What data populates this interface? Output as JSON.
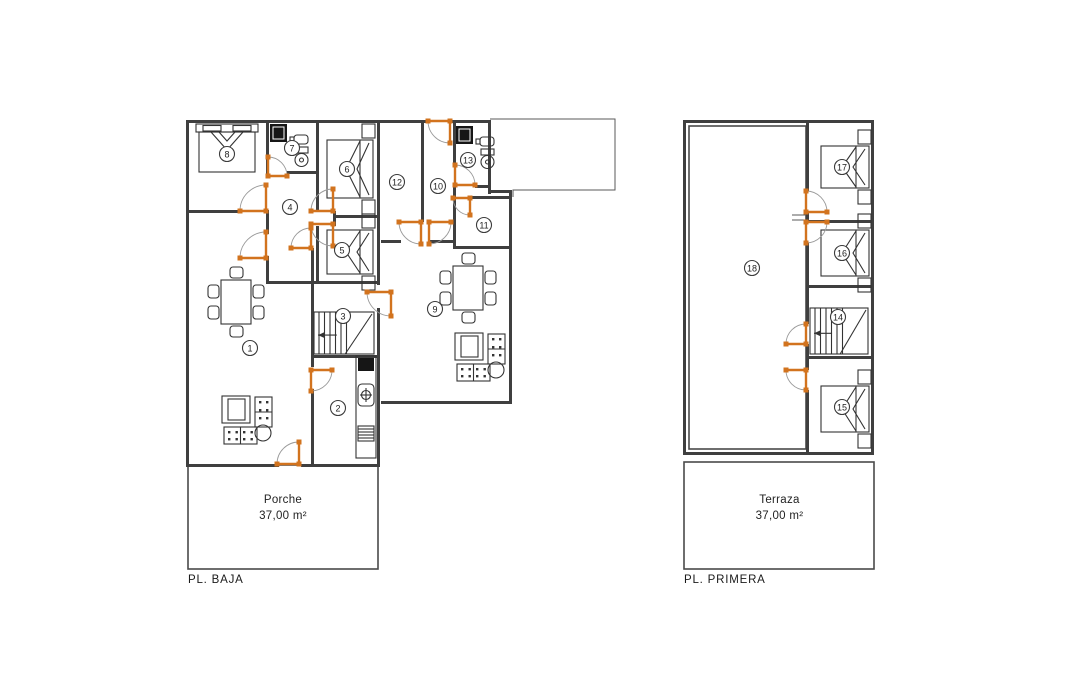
{
  "colors": {
    "wall": "#3f3f3f",
    "door_accent": "#d2731e",
    "swing_arc": "#9a9a9a",
    "text": "#222222"
  },
  "plans": [
    {
      "id": "baja",
      "label": "PL. BAJA",
      "label_pos": [
        188,
        574
      ],
      "area": {
        "title": "Porche",
        "value": "37,00 m²",
        "pos": [
          195,
          492,
          176
        ]
      },
      "walls": [
        {
          "x": 186,
          "y": 120,
          "w": 243,
          "h": 3
        },
        {
          "x": 450,
          "y": 120,
          "w": 41,
          "h": 3
        },
        {
          "x": 186,
          "y": 120,
          "w": 3,
          "h": 347
        },
        {
          "x": 186,
          "y": 464,
          "w": 93,
          "h": 3
        },
        {
          "x": 301,
          "y": 464,
          "w": 79,
          "h": 3
        },
        {
          "x": 488,
          "y": 120,
          "w": 3,
          "h": 74
        },
        {
          "x": 488,
          "y": 190,
          "w": 24,
          "h": 3
        },
        {
          "x": 509,
          "y": 192,
          "w": 3,
          "h": 212
        },
        {
          "x": 381,
          "y": 401,
          "w": 130,
          "h": 3
        },
        {
          "x": 266,
          "y": 120,
          "w": 3,
          "h": 54
        },
        {
          "x": 316,
          "y": 120,
          "w": 3,
          "h": 91
        },
        {
          "x": 316,
          "y": 226,
          "w": 3,
          "h": 57
        },
        {
          "x": 333,
          "y": 211,
          "w": 3,
          "h": 15
        },
        {
          "x": 333,
          "y": 215,
          "w": 46,
          "h": 3
        },
        {
          "x": 377,
          "y": 120,
          "w": 3,
          "h": 165
        },
        {
          "x": 377,
          "y": 308,
          "w": 3,
          "h": 156
        },
        {
          "x": 421,
          "y": 123,
          "w": 3,
          "h": 99
        },
        {
          "x": 453,
          "y": 123,
          "w": 3,
          "h": 44
        },
        {
          "x": 453,
          "y": 187,
          "w": 3,
          "h": 62
        },
        {
          "x": 287,
          "y": 171,
          "w": 31,
          "h": 3
        },
        {
          "x": 186,
          "y": 210,
          "w": 56,
          "h": 3
        },
        {
          "x": 266,
          "y": 210,
          "w": 3,
          "h": 24
        },
        {
          "x": 266,
          "y": 256,
          "w": 3,
          "h": 27
        },
        {
          "x": 266,
          "y": 281,
          "w": 48,
          "h": 3
        },
        {
          "x": 311,
          "y": 248,
          "w": 3,
          "h": 35
        },
        {
          "x": 312,
          "y": 281,
          "w": 68,
          "h": 3
        },
        {
          "x": 311,
          "y": 281,
          "w": 3,
          "h": 86
        },
        {
          "x": 311,
          "y": 389,
          "w": 3,
          "h": 77
        },
        {
          "x": 312,
          "y": 355,
          "w": 66,
          "h": 3
        },
        {
          "x": 429,
          "y": 240,
          "w": 26,
          "h": 3
        },
        {
          "x": 381,
          "y": 240,
          "w": 20,
          "h": 3
        },
        {
          "x": 470,
          "y": 196,
          "w": 42,
          "h": 3
        },
        {
          "x": 453,
          "y": 246,
          "w": 59,
          "h": 3
        },
        {
          "x": 475,
          "y": 185,
          "w": 16,
          "h": 3
        }
      ],
      "thin_rects": [
        {
          "x": 188,
          "y": 465,
          "w": 190,
          "h": 104
        }
      ],
      "polylines": [
        [
          490,
          119,
          615,
          119,
          615,
          190,
          513,
          190,
          513,
          197
        ]
      ],
      "lines": [],
      "doors": [
        {
          "cx": 450,
          "cy": 121,
          "r": 22,
          "a0": 90,
          "a1": 180
        },
        {
          "cx": 266,
          "cy": 211,
          "r": 26,
          "a0": 180,
          "a1": 270
        },
        {
          "cx": 268,
          "cy": 176,
          "r": 19,
          "a0": 270,
          "a1": 360
        },
        {
          "cx": 333,
          "cy": 211,
          "r": 22,
          "a0": 180,
          "a1": 270
        },
        {
          "cx": 333,
          "cy": 224,
          "r": 22,
          "a0": 90,
          "a1": 180
        },
        {
          "cx": 266,
          "cy": 258,
          "r": 26,
          "a0": 180,
          "a1": 270
        },
        {
          "cx": 311,
          "cy": 248,
          "r": 20,
          "a0": 180,
          "a1": 270
        },
        {
          "cx": 391,
          "cy": 292,
          "r": 24,
          "a0": 90,
          "a1": 180
        },
        {
          "cx": 311,
          "cy": 370,
          "r": 21,
          "a0": 0,
          "a1": 90
        },
        {
          "cx": 299,
          "cy": 464,
          "r": 22,
          "a0": 180,
          "a1": 270
        },
        {
          "cx": 421,
          "cy": 222,
          "r": 22,
          "a0": 90,
          "a1": 180
        },
        {
          "cx": 429,
          "cy": 222,
          "r": 22,
          "a0": 0,
          "a1": 90
        },
        {
          "cx": 470,
          "cy": 198,
          "r": 17,
          "a0": 90,
          "a1": 180
        },
        {
          "cx": 455,
          "cy": 185,
          "r": 20,
          "a0": 270,
          "a1": 360
        }
      ],
      "furniture": [
        {
          "type": "bed-top",
          "x": 199,
          "y": 124,
          "w": 56,
          "h": 48
        },
        {
          "type": "bed-right",
          "x": 327,
          "y": 140,
          "w": 46,
          "h": 58
        },
        {
          "type": "bed-right",
          "x": 327,
          "y": 230,
          "w": 46,
          "h": 44
        },
        {
          "type": "table",
          "x": 221,
          "y": 280
        },
        {
          "type": "table",
          "x": 453,
          "y": 266
        },
        {
          "type": "sofa",
          "x": 222,
          "y": 396
        },
        {
          "type": "sofa",
          "x": 455,
          "y": 333
        },
        {
          "type": "bath",
          "x": 270,
          "y": 124
        },
        {
          "type": "bath",
          "x": 456,
          "y": 126
        },
        {
          "type": "kitchen",
          "x": 356,
          "y": 356
        },
        {
          "type": "stairs",
          "x": 314,
          "y": 312,
          "w": 60,
          "h": 42
        }
      ],
      "rooms": [
        {
          "n": "1",
          "x": 250,
          "y": 348
        },
        {
          "n": "2",
          "x": 338,
          "y": 408
        },
        {
          "n": "3",
          "x": 343,
          "y": 316
        },
        {
          "n": "4",
          "x": 290,
          "y": 207
        },
        {
          "n": "5",
          "x": 342,
          "y": 250
        },
        {
          "n": "6",
          "x": 347,
          "y": 169
        },
        {
          "n": "7",
          "x": 292,
          "y": 148
        },
        {
          "n": "8",
          "x": 227,
          "y": 154
        },
        {
          "n": "9",
          "x": 435,
          "y": 309
        },
        {
          "n": "10",
          "x": 438,
          "y": 186
        },
        {
          "n": "11",
          "x": 484,
          "y": 225
        },
        {
          "n": "12",
          "x": 397,
          "y": 182
        },
        {
          "n": "13",
          "x": 468,
          "y": 160
        }
      ]
    },
    {
      "id": "primera",
      "label": "PL. PRIMERA",
      "label_pos": [
        684,
        574
      ],
      "area": {
        "title": "Terraza",
        "value": "37,00 m²",
        "pos": [
          692,
          492,
          175
        ]
      },
      "walls": [
        {
          "x": 683,
          "y": 120,
          "w": 191,
          "h": 3
        },
        {
          "x": 683,
          "y": 120,
          "w": 3,
          "h": 335
        },
        {
          "x": 871,
          "y": 120,
          "w": 3,
          "h": 335
        },
        {
          "x": 683,
          "y": 452,
          "w": 191,
          "h": 3
        },
        {
          "x": 806,
          "y": 123,
          "w": 3,
          "h": 68
        },
        {
          "x": 806,
          "y": 212,
          "w": 3,
          "h": 10
        },
        {
          "x": 806,
          "y": 243,
          "w": 3,
          "h": 81
        },
        {
          "x": 806,
          "y": 344,
          "w": 3,
          "h": 26
        },
        {
          "x": 806,
          "y": 390,
          "w": 3,
          "h": 62
        },
        {
          "x": 806,
          "y": 220,
          "w": 65,
          "h": 3
        },
        {
          "x": 806,
          "y": 285,
          "w": 65,
          "h": 3
        },
        {
          "x": 806,
          "y": 356,
          "w": 65,
          "h": 3
        }
      ],
      "thin_rects": [
        {
          "x": 689,
          "y": 126,
          "w": 117,
          "h": 323
        },
        {
          "x": 684,
          "y": 462,
          "w": 190,
          "h": 107
        }
      ],
      "polylines": [],
      "lines": [
        {
          "x1": 792,
          "y1": 215,
          "x2": 806,
          "y2": 215
        },
        {
          "x1": 792,
          "y1": 220,
          "x2": 806,
          "y2": 220
        }
      ],
      "doors": [
        {
          "cx": 806,
          "cy": 212,
          "r": 21,
          "a0": 270,
          "a1": 360
        },
        {
          "cx": 806,
          "cy": 222,
          "r": 21,
          "a0": 0,
          "a1": 90
        },
        {
          "cx": 806,
          "cy": 344,
          "r": 20,
          "a0": 180,
          "a1": 270
        },
        {
          "cx": 806,
          "cy": 370,
          "r": 20,
          "a0": 90,
          "a1": 180
        }
      ],
      "furniture": [
        {
          "type": "bed-right",
          "x": 821,
          "y": 146,
          "w": 48,
          "h": 42
        },
        {
          "type": "bed-right",
          "x": 821,
          "y": 230,
          "w": 48,
          "h": 46
        },
        {
          "type": "bed-right",
          "x": 821,
          "y": 386,
          "w": 48,
          "h": 46
        },
        {
          "type": "stairs",
          "x": 810,
          "y": 308,
          "w": 58,
          "h": 46
        }
      ],
      "rooms": [
        {
          "n": "14",
          "x": 838,
          "y": 317
        },
        {
          "n": "15",
          "x": 842,
          "y": 407
        },
        {
          "n": "16",
          "x": 842,
          "y": 253
        },
        {
          "n": "17",
          "x": 842,
          "y": 167
        },
        {
          "n": "18",
          "x": 752,
          "y": 268
        }
      ]
    }
  ]
}
